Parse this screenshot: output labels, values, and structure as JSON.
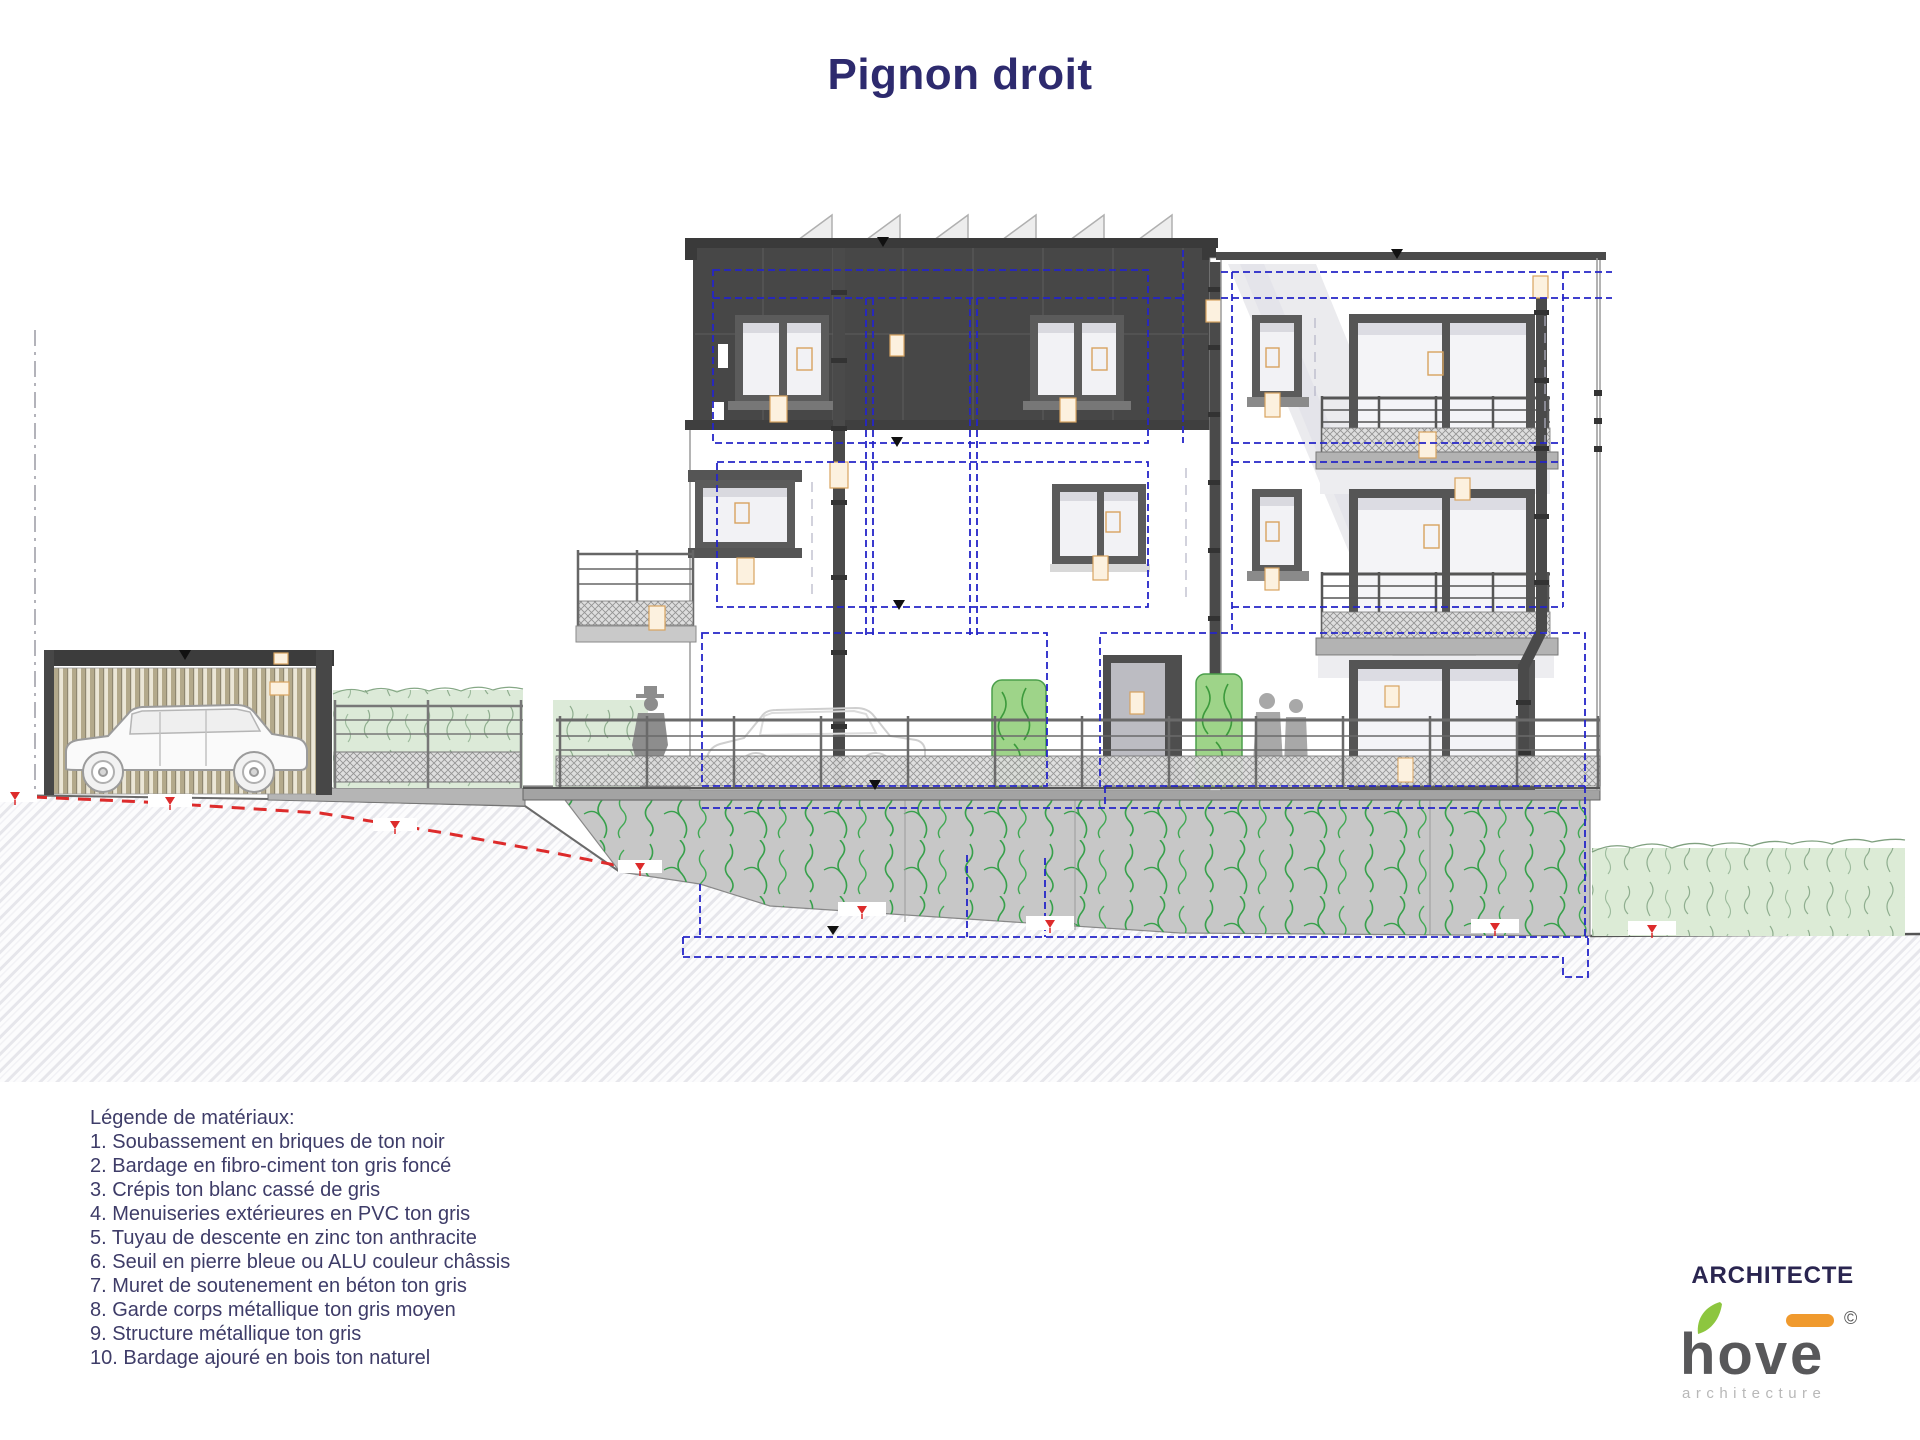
{
  "title": "Pignon droit",
  "legend": {
    "heading": "Légende de matériaux:",
    "items": [
      "1. Soubassement en briques de ton noir",
      "2. Bardage en fibro-ciment ton gris foncé",
      "3. Crépis ton blanc cassé de gris",
      "4. Menuiseries extérieures en PVC ton gris",
      "5. Tuyau de descente en zinc ton anthracite",
      "6. Seuil en pierre bleue ou ALU couleur châssis",
      "7. Muret de soutenement en béton ton gris",
      "8. Garde corps métallique ton gris moyen",
      "9. Structure métallique ton gris",
      "10. Bardage ajouré en bois ton naturel"
    ]
  },
  "architect": {
    "label": "ARCHITECTE"
  },
  "logo": {
    "name_head": "hov",
    "name_tail": "e",
    "copyright": "©",
    "subtitle": "architecture"
  },
  "drawing": {
    "view_name": "right-gable-elevation",
    "colors": {
      "title_text": "#2d2a6e",
      "legend_text": "#3e3c68",
      "cladding_dark": "#474747",
      "annotation_blue": "#2525c8",
      "terrain_red": "#dd2b2b",
      "vegetation_green": "#2f9e44",
      "retaining_wall_gray": "#c7c7c7",
      "logo_leaf_green": "#8dc63f",
      "logo_bar_orange": "#f09a2e"
    }
  }
}
